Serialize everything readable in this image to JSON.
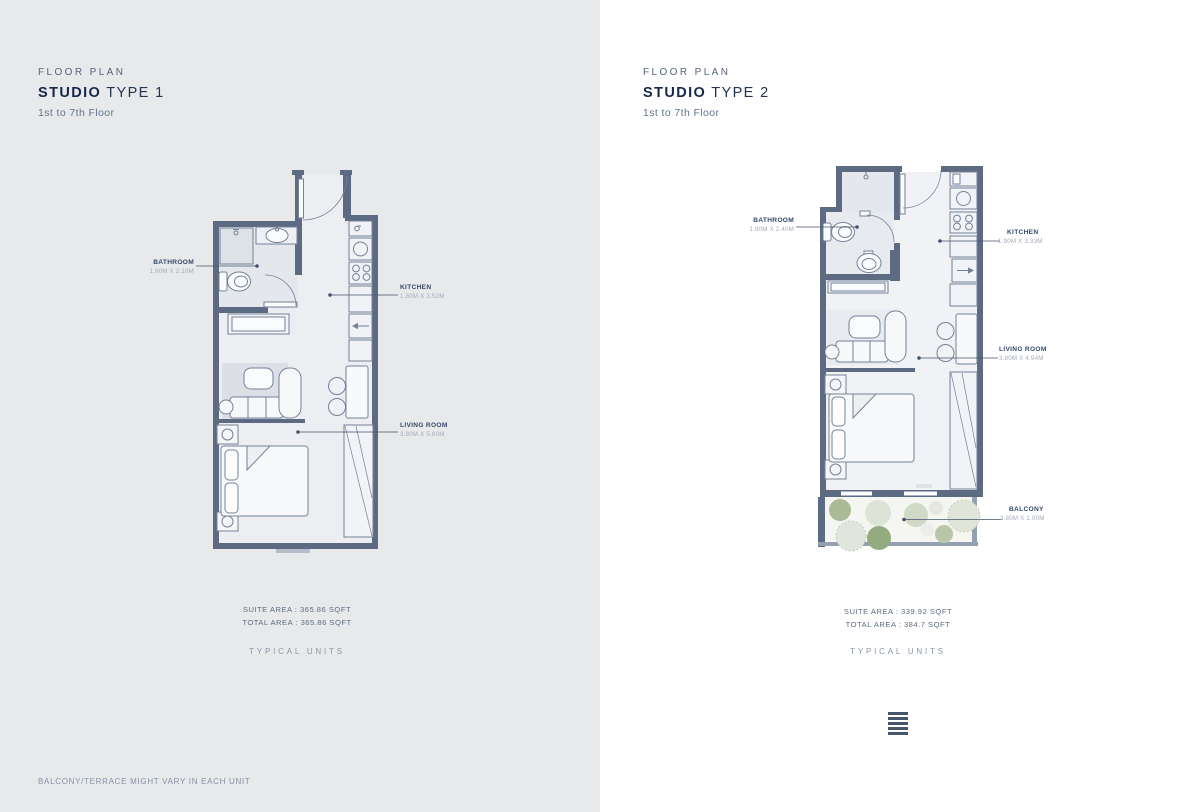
{
  "colors": {
    "panel_left_bg": "#e8e9eb",
    "panel_right_bg": "#ffffff",
    "wall": "#5c6b81",
    "accent_navy": "#16284a",
    "label_navy": "#35496c",
    "leader": "#44536b",
    "plant_green": "#9fb48d",
    "plant_sage": "#ccd6c3"
  },
  "plans": [
    {
      "eyebrow": "FLOOR PLAN",
      "title_bold": "STUDIO",
      "title_rest": "TYPE 1",
      "subtitle": "1st to 7th Floor",
      "rooms": [
        {
          "name": "BATHROOM",
          "dims": "1.90M X 2.10M"
        },
        {
          "name": "KITCHEN",
          "dims": "1.80M X 3.52M"
        },
        {
          "name": "LIVING ROOM",
          "dims": "3.80M X 5.60M"
        }
      ],
      "suite_area": "SUITE AREA : 365.86 SQFT",
      "total_area": "TOTAL AREA : 365.86 SQFT",
      "typical_units": "TYPICAL UNITS"
    },
    {
      "eyebrow": "FLOOR PLAN",
      "title_bold": "STUDIO",
      "title_rest": "TYPE 2",
      "subtitle": "1st to 7th Floor",
      "rooms": [
        {
          "name": "BATHROOM",
          "dims": "1.80M X 2.40M"
        },
        {
          "name": "KITCHEN",
          "dims": "1.90M X 3.33M"
        },
        {
          "name": "LIVING ROOM",
          "dims": "3.80M X 4.94M"
        },
        {
          "name": "BALCONY",
          "dims": "3.80M X 1.00M"
        }
      ],
      "suite_area": "SUITE AREA : 339.92 SQFT",
      "total_area": "TOTAL AREA : 384.7 SQFT",
      "typical_units": "TYPICAL UNITS"
    }
  ],
  "footer": {
    "disclaimer": "BALCONY/TERRACE MIGHT VARY IN EACH UNIT"
  },
  "icons": {
    "list_icon": "list-bars"
  }
}
